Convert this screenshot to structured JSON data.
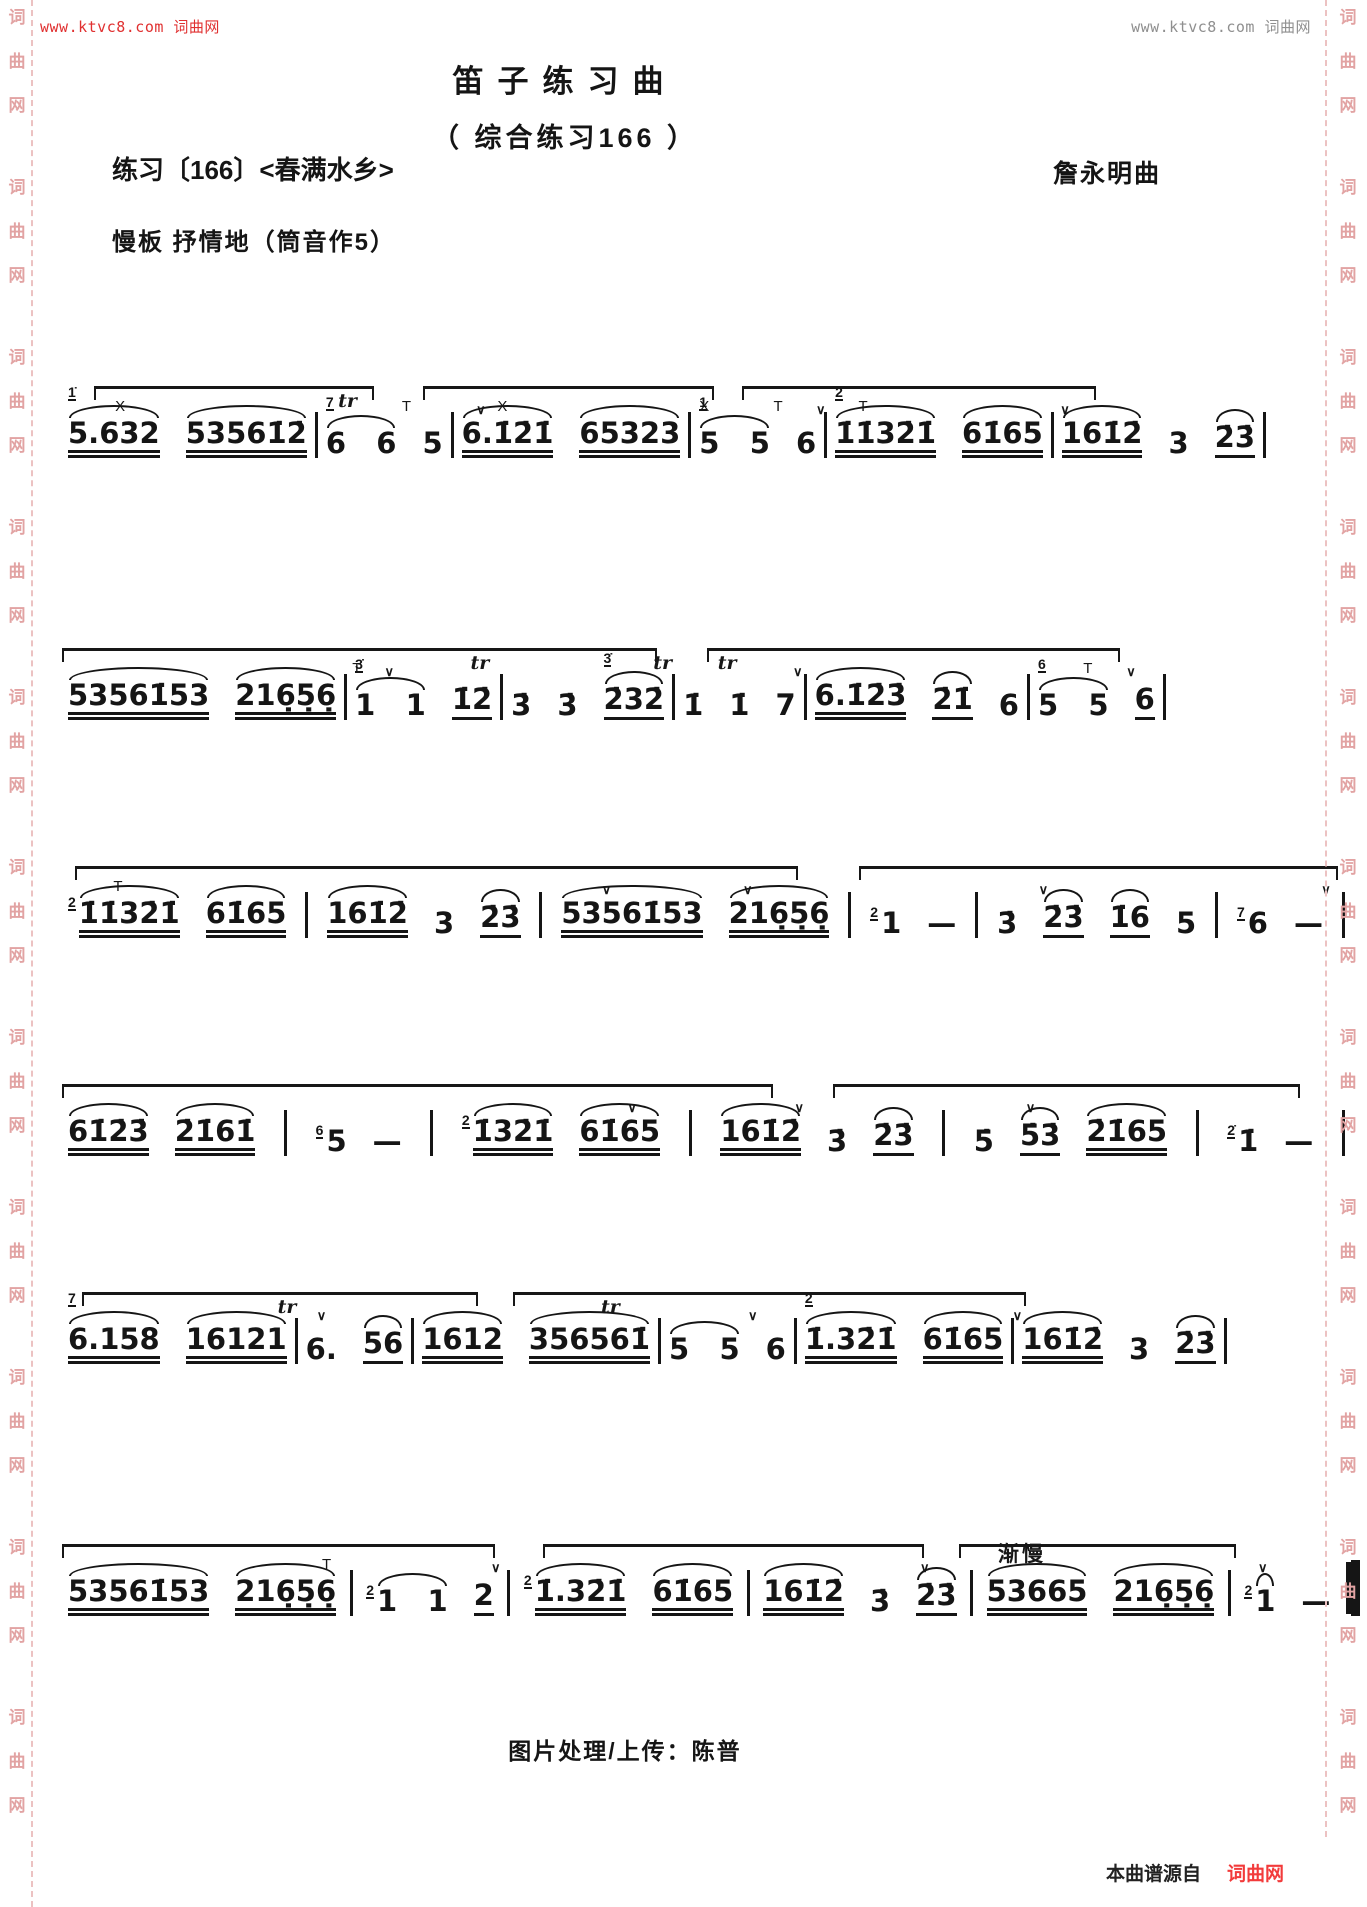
{
  "page": {
    "top_left_link": "www.ktvc8.com 词曲网",
    "top_right_link": "www.ktvc8.com 词曲网",
    "side_watermark_chars": [
      "词",
      "曲",
      "网"
    ],
    "colors": {
      "link_red": "#e03030",
      "link_gray": "#8f8f8f",
      "watermark_pink": "#e2a3a3",
      "ink_black": "#151515",
      "brand_red": "#f23b3b"
    }
  },
  "header": {
    "title": "笛子练习曲",
    "subtitle": "（ 综合练习166 ）",
    "exercise_label": "练习〔166〕<春满水乡>",
    "composer": "詹永明曲",
    "tempo": "慢板  抒情地（筒音作5）"
  },
  "footer": {
    "credit": "图片处理/上传：陈普",
    "source_prefix": "本曲谱源自",
    "source_brand": "词曲网"
  },
  "score": {
    "lines": [
      {
        "x": 62,
        "y": 378,
        "w": 1062,
        "end": "bar",
        "overlines": [
          [
            3,
            26
          ],
          [
            34,
            27
          ],
          [
            64,
            33
          ]
        ],
        "marks": [
          {
            "x": 5,
            "t": "X",
            "k": "tech"
          },
          {
            "x": 26,
            "t": "tr",
            "k": "tr"
          },
          {
            "x": 32,
            "t": "T",
            "k": "tech"
          },
          {
            "x": 39,
            "t": "∨",
            "k": "v"
          },
          {
            "x": 41,
            "t": "X",
            "k": "tech"
          },
          {
            "x": 60,
            "t": "X",
            "k": "tech"
          },
          {
            "x": 67,
            "t": "T",
            "k": "tech"
          },
          {
            "x": 71,
            "t": "∨",
            "k": "v"
          },
          {
            "x": 75,
            "t": "T",
            "k": "tech"
          },
          {
            "x": 94,
            "t": "∨",
            "k": "v"
          }
        ],
        "measures": [
          [
            {
              "g": "1̇",
              "t": "5.632",
              "b": 2,
              "a": 1
            },
            {
              "t": "53561̇2̇",
              "b": 2,
              "a": 1
            }
          ],
          [
            {
              "g": "7",
              "t": "6   6",
              "a": 1
            },
            {
              "t": "5"
            }
          ],
          [
            {
              "t": "6.1̇2̇1̇",
              "b": 2,
              "a": 1
            },
            {
              "t": "65323",
              "b": 2,
              "a": 1
            }
          ],
          [
            {
              "g": "1",
              "t": "5   5",
              "a": 1
            },
            {
              "t": "6"
            }
          ],
          [
            {
              "g": "2",
              "t": "1̇1̇32̇1̇",
              "b": 2,
              "a": 1
            },
            {
              "t": "61̇65",
              "b": 2,
              "a": 1
            }
          ],
          [
            {
              "t": "161̇2̇",
              "b": 2,
              "a": 1
            },
            {
              "t": "3"
            },
            {
              "t": "2̇3̇",
              "b": 1,
              "a": 1
            }
          ]
        ]
      },
      {
        "x": 62,
        "y": 640,
        "w": 1075,
        "end": "bar",
        "overlines": [
          [
            0,
            55
          ],
          [
            60,
            38
          ]
        ],
        "marks": [
          {
            "x": 27,
            "t": "T",
            "k": "tech"
          },
          {
            "x": 30,
            "t": "∨",
            "k": "v"
          },
          {
            "x": 38,
            "t": "tr",
            "k": "tr"
          },
          {
            "x": 55,
            "t": "tr",
            "k": "tr"
          },
          {
            "x": 61,
            "t": "tr",
            "k": "tr"
          },
          {
            "x": 68,
            "t": "∨",
            "k": "v"
          },
          {
            "x": 95,
            "t": "T",
            "k": "tech"
          },
          {
            "x": 99,
            "t": "∨",
            "k": "v"
          }
        ],
        "measures": [
          [
            {
              "t": "53561̇53",
              "b": 2,
              "a": 1
            },
            {
              "t": "216̣5̣6̣",
              "b": 2,
              "a": 1
            }
          ],
          [
            {
              "g": "3̇",
              "t": "1   1",
              "a": 1
            },
            {
              "t": "1̇2̇",
              "b": 1
            }
          ],
          [
            {
              "t": "3̇"
            },
            {
              "t": "3̇"
            },
            {
              "g": "3̇",
              "t": "2̇32̇",
              "b": 1,
              "a": 1
            }
          ],
          [
            {
              "t": "1̇"
            },
            {
              "t": "1̇"
            },
            {
              "t": "7"
            }
          ],
          [
            {
              "t": "6.1̇2̇3̇",
              "b": 2,
              "a": 1
            },
            {
              "t": "2̇1̇",
              "b": 1,
              "a": 1
            },
            {
              "t": "6"
            }
          ],
          [
            {
              "g": "6",
              "t": "5   5",
              "a": 1
            },
            {
              "t": "6",
              "b": 1
            }
          ]
        ]
      },
      {
        "x": 62,
        "y": 858,
        "w": 1285,
        "end": "bar",
        "overlines": [
          [
            1,
            56
          ],
          [
            62,
            37
          ]
        ],
        "marks": [
          {
            "x": 4,
            "t": "T",
            "k": "tech"
          },
          {
            "x": 42,
            "t": "∨",
            "k": "v"
          },
          {
            "x": 53,
            "t": "∨",
            "k": "v"
          },
          {
            "x": 76,
            "t": "∨",
            "k": "v"
          },
          {
            "x": 98,
            "t": "∨",
            "k": "v"
          }
        ],
        "measures": [
          [
            {
              "g": "2",
              "t": "1̇1̇32̇1̇",
              "b": 2,
              "a": 1
            },
            {
              "t": "61̇65",
              "b": 2,
              "a": 1
            }
          ],
          [
            {
              "t": "161̇2̇",
              "b": 2,
              "a": 1
            },
            {
              "t": "3"
            },
            {
              "t": "2̇3̇",
              "b": 1,
              "a": 1
            }
          ],
          [
            {
              "t": "53561̇53",
              "b": 2,
              "a": 1
            },
            {
              "t": "216̣5̣6̣",
              "b": 2,
              "a": 1
            }
          ],
          [
            {
              "g": "2",
              "t": "1"
            },
            {
              "t": "—"
            }
          ],
          [
            {
              "t": "3̇"
            },
            {
              "t": "2̇3̇",
              "b": 1,
              "a": 1
            },
            {
              "t": "1̇6",
              "b": 1,
              "a": 1
            },
            {
              "t": "5"
            }
          ],
          [
            {
              "g": "7",
              "t": "6"
            },
            {
              "t": "—"
            }
          ]
        ]
      },
      {
        "x": 62,
        "y": 1076,
        "w": 1285,
        "end": "bar",
        "overlines": [
          [
            0,
            55
          ],
          [
            60,
            36
          ]
        ],
        "marks": [
          {
            "x": 44,
            "t": "∨",
            "k": "v"
          },
          {
            "x": 57,
            "t": "∨",
            "k": "v"
          },
          {
            "x": 75,
            "t": "∨",
            "k": "v"
          }
        ],
        "measures": [
          [
            {
              "t": "61̇2̇3̇",
              "b": 2,
              "a": 1
            },
            {
              "t": "2̇1̇61̇",
              "b": 2,
              "a": 1
            }
          ],
          [
            {
              "g": "6",
              "t": "5"
            },
            {
              "t": "—"
            }
          ],
          [
            {
              "g": "2",
              "t": "1̇32̇1̇",
              "b": 2,
              "a": 1
            },
            {
              "t": "61̇65",
              "b": 2,
              "a": 1
            }
          ],
          [
            {
              "t": "161̇2̇",
              "b": 2,
              "a": 1
            },
            {
              "t": "3̇"
            },
            {
              "t": "2̇3̇",
              "b": 1,
              "a": 1
            }
          ],
          [
            {
              "t": "5̇"
            },
            {
              "t": "5̇3̇",
              "b": 1,
              "a": 1
            },
            {
              "t": "2̇1̇65",
              "b": 2,
              "a": 1
            }
          ],
          [
            {
              "g": "2̇",
              "t": "1̇"
            },
            {
              "t": "—"
            }
          ]
        ]
      },
      {
        "x": 62,
        "y": 1284,
        "w": 980,
        "end": "bar",
        "overlines": [
          [
            2,
            40
          ],
          [
            46,
            52
          ]
        ],
        "marks": [
          {
            "x": 22,
            "t": "tr",
            "k": "tr"
          },
          {
            "x": 26,
            "t": "∨",
            "k": "v"
          },
          {
            "x": 55,
            "t": "tr",
            "k": "tr"
          },
          {
            "x": 70,
            "t": "∨",
            "k": "v"
          },
          {
            "x": 97,
            "t": "∨",
            "k": "v"
          }
        ],
        "measures": [
          [
            {
              "g": "7",
              "t": "6.158",
              "b": 2,
              "a": 1
            },
            {
              "t": "16121",
              "b": 2,
              "a": 1
            }
          ],
          [
            {
              "t": "6."
            },
            {
              "t": "56",
              "b": 1,
              "a": 1
            }
          ],
          [
            {
              "t": "1612",
              "b": 2,
              "a": 1
            },
            {
              "t": "356561̇",
              "b": 2,
              "a": 1
            }
          ],
          [
            {
              "t": "5   5",
              "a": 1
            },
            {
              "t": "6"
            }
          ],
          [
            {
              "g": "2",
              "t": "1̇.32̇1̇",
              "b": 2,
              "a": 1
            },
            {
              "t": "61̇65",
              "b": 2,
              "a": 1
            }
          ],
          [
            {
              "t": "161̇2̇",
              "b": 2,
              "a": 1
            },
            {
              "t": "3"
            },
            {
              "t": "2̇3̇",
              "b": 1,
              "a": 1
            }
          ]
        ]
      },
      {
        "x": 62,
        "y": 1536,
        "w": 1300,
        "end": "final",
        "overlines": [
          [
            0,
            33
          ],
          [
            37,
            29
          ],
          [
            69,
            21
          ]
        ],
        "marks": [
          {
            "x": 20,
            "t": "T",
            "k": "tech"
          },
          {
            "x": 33,
            "t": "∨",
            "k": "v"
          },
          {
            "x": 66,
            "t": "∨",
            "k": "v"
          },
          {
            "x": 72,
            "t": "渐慢",
            "k": "cn"
          },
          {
            "x": 92,
            "t": "∨",
            "k": "v"
          }
        ],
        "measures": [
          [
            {
              "t": "53561̇53",
              "b": 2,
              "a": 1
            },
            {
              "t": "216̣5̣6̣",
              "b": 2,
              "a": 1
            }
          ],
          [
            {
              "g": "2",
              "t": "1   1",
              "a": 1
            },
            {
              "t": "2",
              "b": 1
            }
          ],
          [
            {
              "g": "2",
              "t": "1̇.32̇1̇",
              "b": 2,
              "a": 1
            },
            {
              "t": "61̇65",
              "b": 2,
              "a": 1
            }
          ],
          [
            {
              "t": "161̇2̇",
              "b": 2,
              "a": 1
            },
            {
              "t": "3̇"
            },
            {
              "t": "2̇3̇",
              "b": 1,
              "a": 1
            }
          ],
          [
            {
              "t": "53665",
              "b": 2,
              "a": 1
            },
            {
              "t": "216̣5̣6̣",
              "b": 2,
              "a": 1
            }
          ],
          [
            {
              "g": "2",
              "t": "1",
              "a": 1
            },
            {
              "t": "—"
            }
          ]
        ]
      }
    ]
  }
}
